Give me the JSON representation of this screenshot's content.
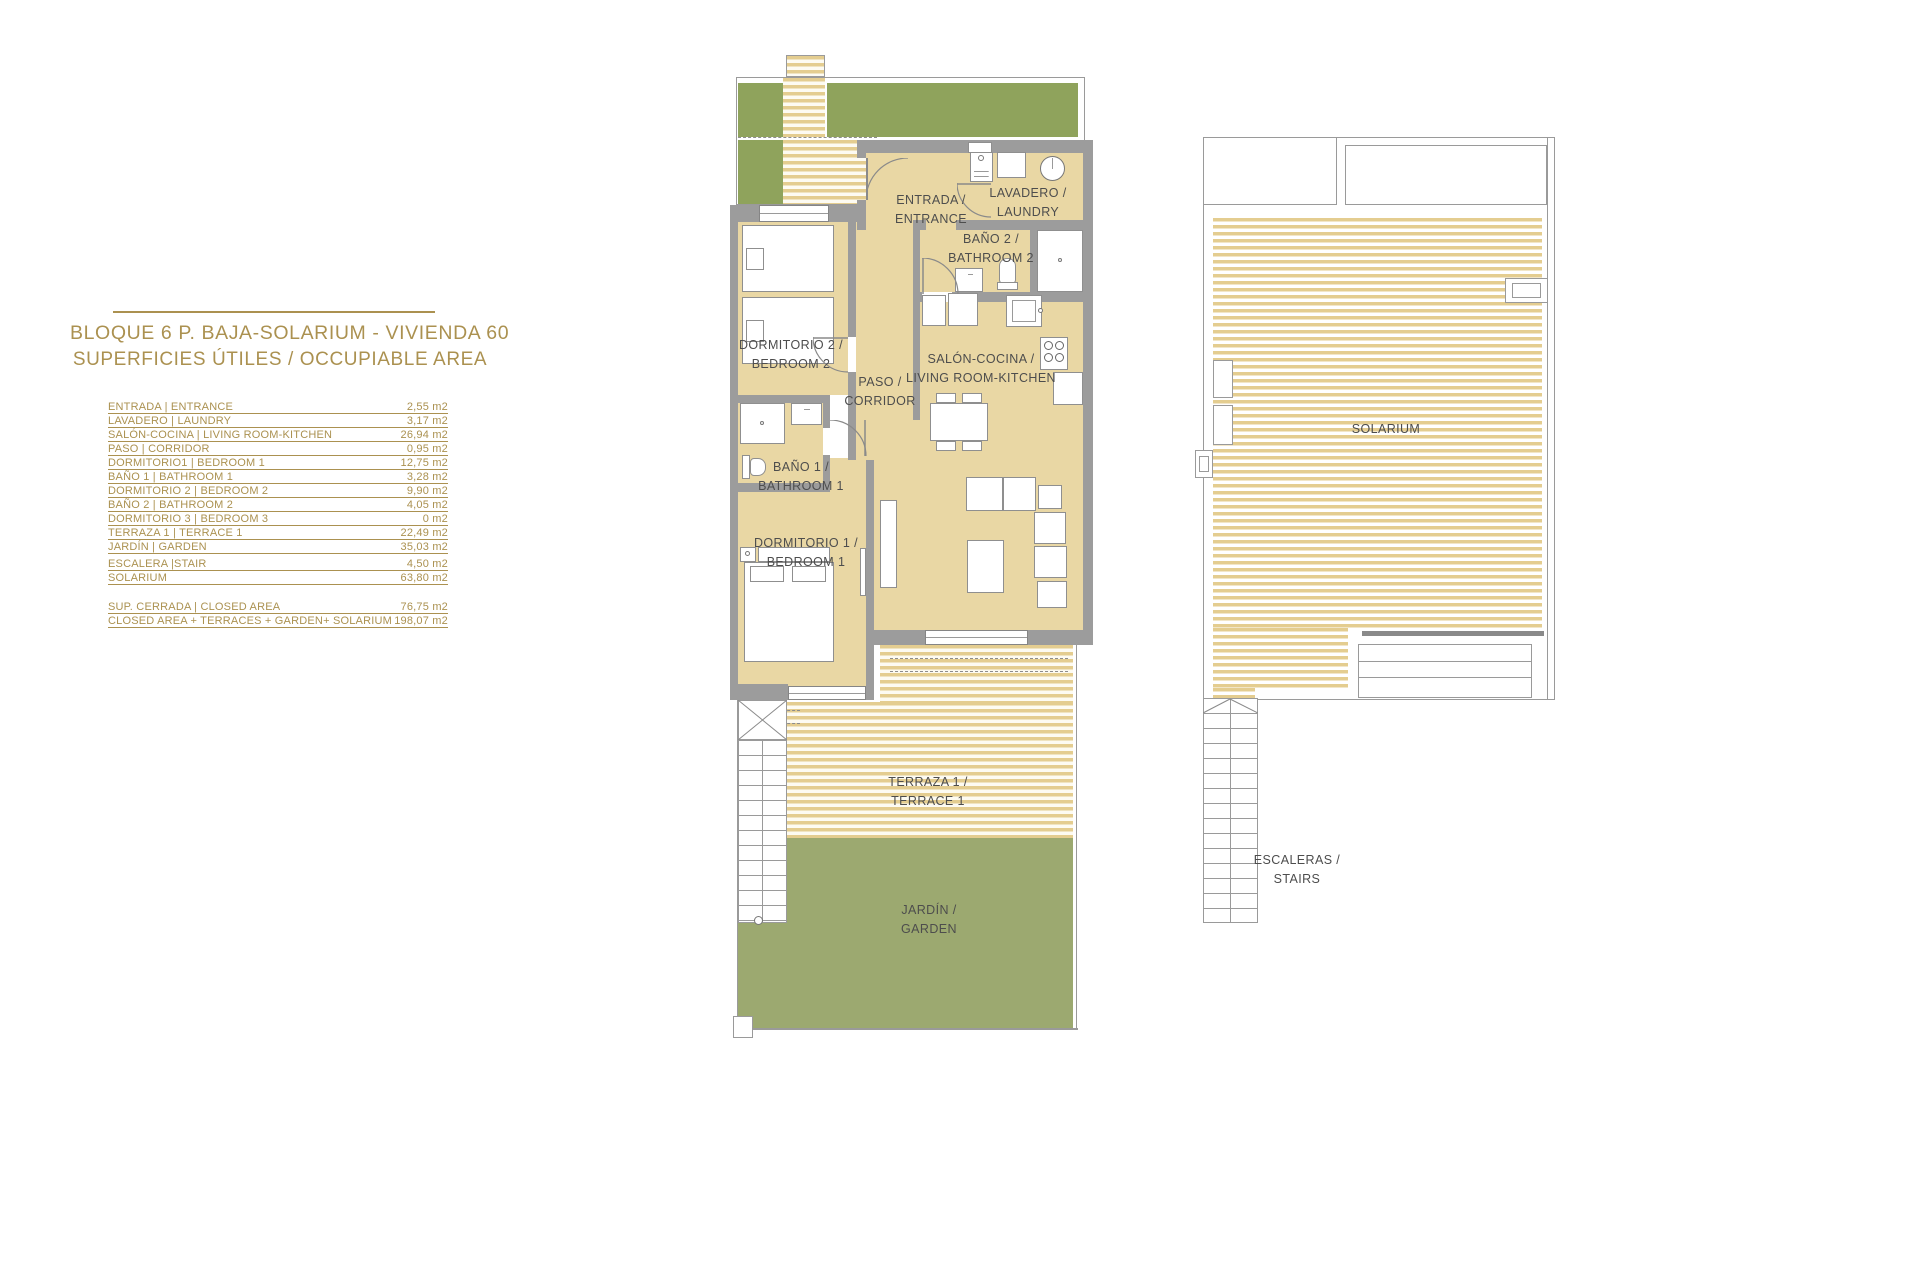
{
  "colors": {
    "accent_gold": "#ab9150",
    "room_fill": "#e9d7a4",
    "terrace_stripe": "#e4cd90",
    "garden_green": "#9ca970",
    "top_garden_green": "#8fa35c",
    "wall_gray": "#9c9c9c",
    "line_gray": "#9a9a9a",
    "label_text": "#4d4d4d"
  },
  "info": {
    "title_line1": "BLOQUE 6 P. BAJA-SOLARIUM - VIVIENDA 60",
    "title_line2": "SUPERFICIES ÚTILES / OCCUPIABLE AREA",
    "rows": [
      {
        "label": "ENTRADA | ENTRANCE",
        "value": "2,55 m2"
      },
      {
        "label": "LAVADERO | LAUNDRY",
        "value": "3,17 m2"
      },
      {
        "label": "SALÓN-COCINA | LIVING ROOM-KITCHEN",
        "value": "26,94 m2"
      },
      {
        "label": "PASO | CORRIDOR",
        "value": "0,95 m2"
      },
      {
        "label": "DORMITORIO1 | BEDROOM 1",
        "value": "12,75 m2"
      },
      {
        "label": "BAÑO 1 | BATHROOM 1",
        "value": "3,28 m2"
      },
      {
        "label": "DORMITORIO 2 | BEDROOM 2",
        "value": "9,90 m2"
      },
      {
        "label": "BAÑO 2 | BATHROOM 2",
        "value": "4,05 m2"
      },
      {
        "label": "DORMITORIO 3 | BEDROOM 3",
        "value": "0 m2"
      },
      {
        "label": "TERRAZA 1 | TERRACE 1",
        "value": "22,49 m2"
      },
      {
        "label": "JARDÍN | GARDEN",
        "value": "35,03 m2"
      },
      {
        "label": "ESCALERA |STAIR",
        "value": "4,50 m2"
      },
      {
        "label": "SOLARIUM",
        "value": "63,80 m2"
      }
    ],
    "summary_rows": [
      {
        "label": "SUP. CERRADA | CLOSED AREA",
        "value": "76,75 m2"
      },
      {
        "label": "CLOSED AREA + TERRACES + GARDEN+ SOLARIUM",
        "value": "198,07 m2"
      }
    ]
  },
  "plan": {
    "entrance": {
      "l1": "ENTRADA /",
      "l2": "ENTRANCE"
    },
    "laundry": {
      "l1": "LAVADERO /",
      "l2": "LAUNDRY"
    },
    "bathroom2": {
      "l1": "BAÑO 2 /",
      "l2": "BATHROOM 2"
    },
    "bedroom2": {
      "l1": "DORMITORIO 2 /",
      "l2": "BEDROOM 2"
    },
    "living": {
      "l1": "SALÓN-COCINA /",
      "l2": "LIVING ROOM-KITCHEN"
    },
    "corridor": {
      "l1": "PASO /",
      "l2": "CORRIDOR"
    },
    "bathroom1": {
      "l1": "BAÑO 1 /",
      "l2": "BATHROOM 1"
    },
    "bedroom1": {
      "l1": "DORMITORIO 1 /",
      "l2": "BEDROOM 1"
    },
    "terrace": {
      "l1": "TERRAZA 1 /",
      "l2": "TERRACE 1"
    },
    "garden": {
      "l1": "JARDÍN /",
      "l2": "GARDEN"
    },
    "solarium": {
      "l1": "SOLARIUM"
    },
    "stairs": {
      "l1": "ESCALERAS /",
      "l2": "STAIRS"
    }
  }
}
